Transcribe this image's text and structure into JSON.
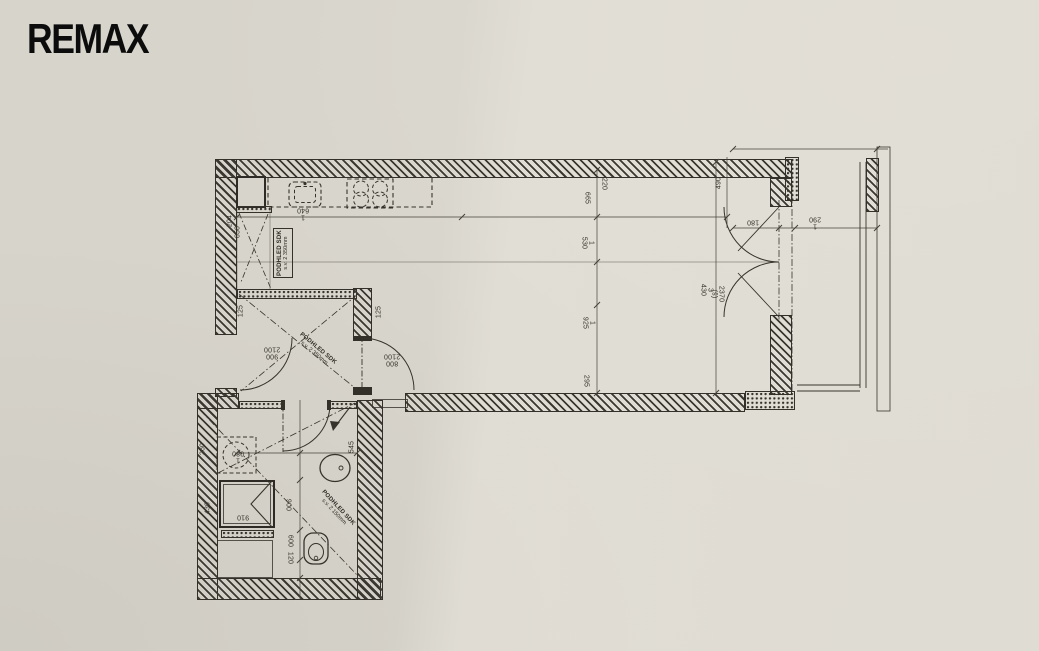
{
  "logo": {
    "text": "REMAX"
  },
  "colors": {
    "paper": "#d7d4cb",
    "paper_light": "#e2dfd6",
    "ink": "#34312b"
  },
  "plan": {
    "ceiling_notes": {
      "kitchen": {
        "line1": "PODHLED SDK",
        "line2": "s.v. 2 350mm"
      },
      "hall": {
        "line1": "PODHLED SDK",
        "line2": "s.v. 2 350mm"
      },
      "bathroom": {
        "line1": "PODHLED SDK",
        "line2": "s.v. 2 150mm"
      }
    },
    "dimensions": [
      {
        "text": "1 640",
        "x": 303,
        "y": 213,
        "rot": 180
      },
      {
        "text": "204",
        "x": 230,
        "y": 221,
        "rot": -90
      },
      {
        "text": "650",
        "x": 238,
        "y": 232,
        "rot": -90
      },
      {
        "text": "220",
        "x": 604,
        "y": 184,
        "rot": 90
      },
      {
        "text": "665",
        "x": 587,
        "y": 198,
        "rot": 90
      },
      {
        "text": "1 530",
        "x": 587,
        "y": 243,
        "rot": 90
      },
      {
        "text": "1 925",
        "x": 588,
        "y": 323,
        "rot": 90
      },
      {
        "text": "295",
        "x": 586,
        "y": 381,
        "rot": 90
      },
      {
        "text": "490",
        "x": 719,
        "y": 183,
        "rot": -90
      },
      {
        "text": "180",
        "x": 753,
        "y": 222,
        "rot": 180
      },
      {
        "text": "1 290",
        "x": 815,
        "y": 222,
        "rot": 180
      },
      {
        "text": "3 430",
        "x": 706,
        "y": 290,
        "rot": 90
      },
      {
        "text": "2370 (š)",
        "x": 717,
        "y": 294,
        "rot": 90
      },
      {
        "text": "125",
        "x": 241,
        "y": 311,
        "rot": -90
      },
      {
        "text": "125",
        "x": 379,
        "y": 312,
        "rot": -90
      },
      {
        "text": "900\n2100",
        "x": 272,
        "y": 352,
        "rot": 180
      },
      {
        "text": "800\n2100",
        "x": 392,
        "y": 359,
        "rot": 180
      },
      {
        "text": "260",
        "x": 203,
        "y": 449,
        "rot": -90
      },
      {
        "text": "1 080",
        "x": 238,
        "y": 456,
        "rot": 180
      },
      {
        "text": "545",
        "x": 352,
        "y": 447,
        "rot": -90
      },
      {
        "text": "430",
        "x": 208,
        "y": 508,
        "rot": -90
      },
      {
        "text": "910",
        "x": 243,
        "y": 517,
        "rot": 180
      },
      {
        "text": "900",
        "x": 288,
        "y": 505,
        "rot": 90
      },
      {
        "text": "600",
        "x": 290,
        "y": 541,
        "rot": 90
      },
      {
        "text": "120",
        "x": 290,
        "y": 558,
        "rot": 90
      }
    ]
  }
}
